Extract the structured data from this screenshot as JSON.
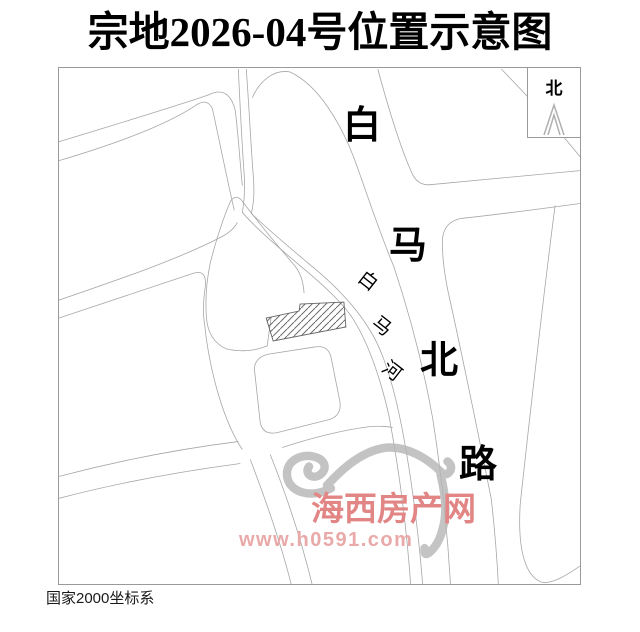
{
  "page": {
    "title": "宗地2026-04号位置示意图",
    "footer": "国家2000坐标系"
  },
  "map": {
    "north_label": "北",
    "road": {
      "name": "白马北路",
      "chars": [
        "白",
        "马",
        "北",
        "路"
      ]
    },
    "river": {
      "name": "白马河",
      "chars": [
        "白",
        "马",
        "河"
      ]
    },
    "watermark": {
      "site_name": "海西房产网",
      "site_url": "www.h0591.com"
    }
  },
  "colors": {
    "map_line": "#a6a6a6",
    "frame_border": "#9a9a9a",
    "parcel_hatch": "#555555",
    "watermark_text": "#e28585",
    "watermark_url": "#e9a9a9",
    "watermark_logo": "#b5b5b5",
    "north_arrow": "#b0b0b0"
  }
}
